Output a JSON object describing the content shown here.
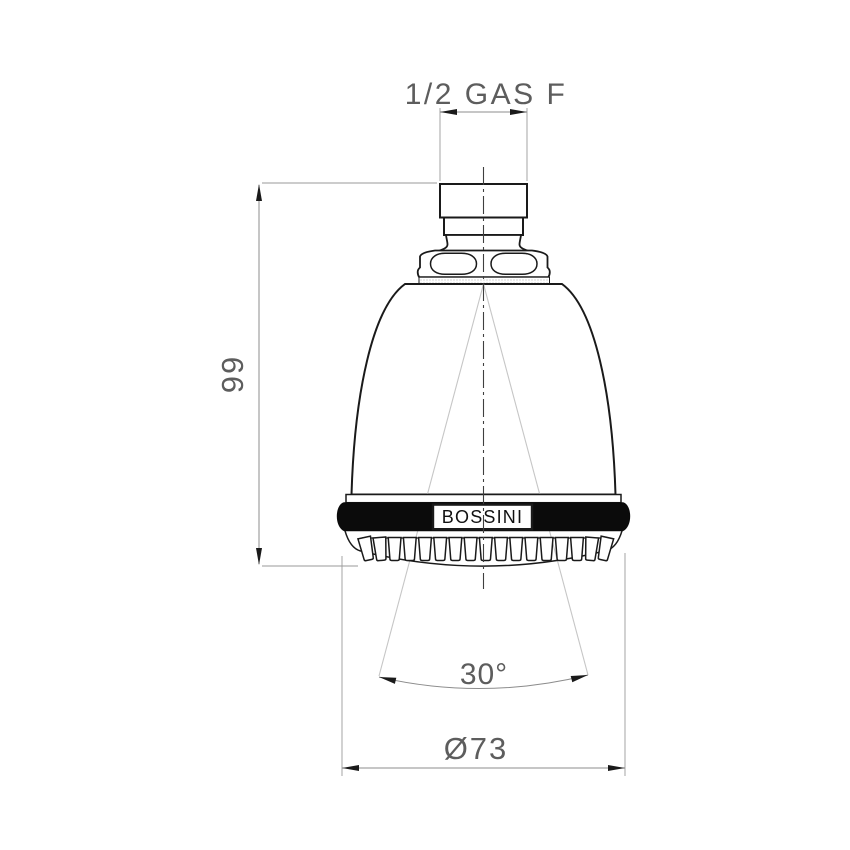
{
  "drawing": {
    "brand_label": "BOSSINI",
    "dimensions": {
      "thread": "1/2 GAS F",
      "height": "99",
      "spray_angle": "30°",
      "diameter": "Ø73"
    },
    "nozzle_count": 17,
    "colors": {
      "outline": "#1a1a1a",
      "dimension_line": "#8c8c8c",
      "dimension_text": "#5d5d5d",
      "collar_band_fill": "#0b0b0b",
      "spray_guide_line": "#c6c6c6",
      "background": "#ffffff"
    }
  }
}
